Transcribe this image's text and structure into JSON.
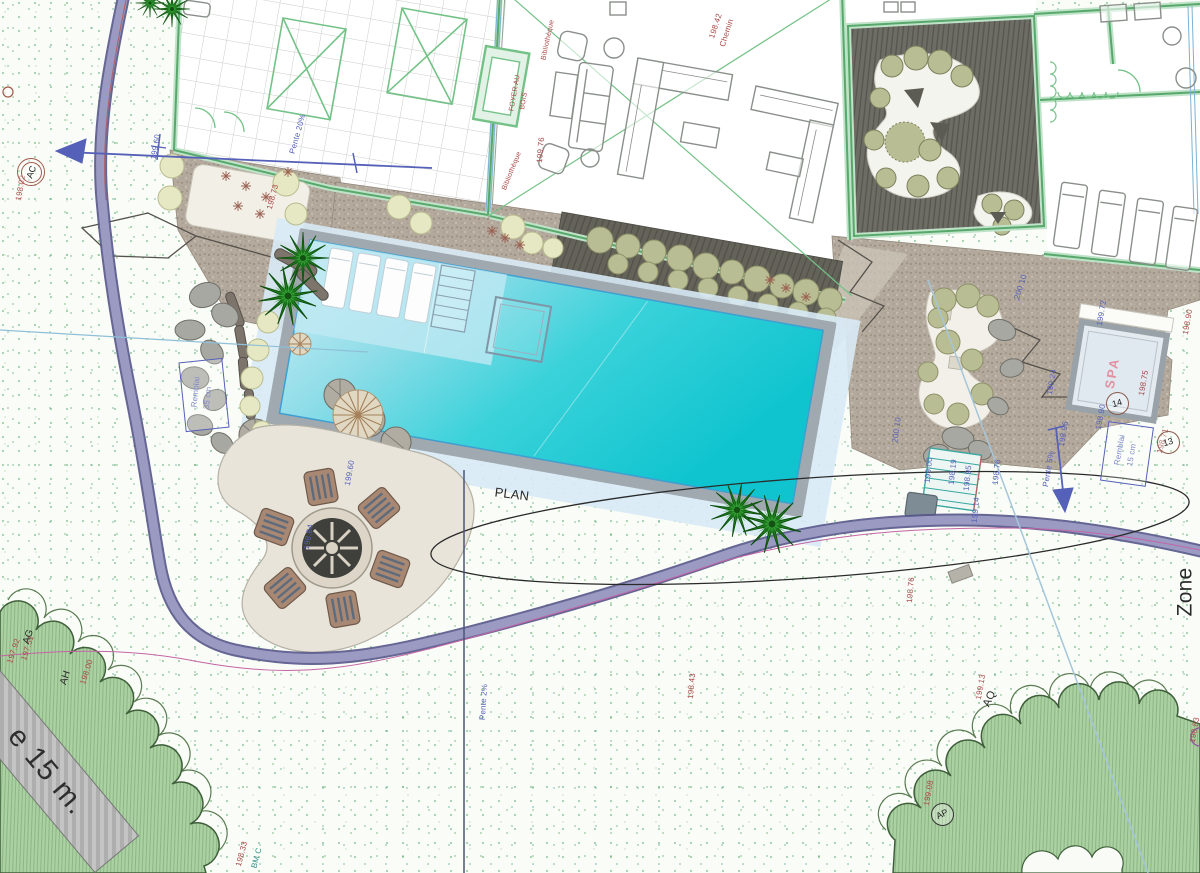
{
  "colors": {
    "pool_water": "#0fc4cf",
    "pool_water_light": "#cdeef7",
    "pool_coping": "#9fa9af",
    "wall_green": "#74c287",
    "path_purple": "#8e8ebb",
    "gravel": "#b4a99d",
    "deck_dark": "#6d6d66",
    "tree_mass_green": "#abd0a2",
    "annotation_red": "#a84848",
    "annotation_blue": "#5560b8",
    "spa_pink": "#e390a0",
    "palm_green": "#1e7d1e"
  },
  "scale_band": {
    "label": "e 15 m."
  },
  "annotations": {
    "texts": [
      {
        "t": "198.42",
        "x": 716,
        "y": 26,
        "r": -72,
        "c": "red"
      },
      {
        "t": "Chemin",
        "x": 727,
        "y": 33,
        "r": -72,
        "c": "red"
      },
      {
        "t": "199.76",
        "x": 541,
        "y": 150,
        "r": -85,
        "c": "red"
      },
      {
        "t": "FOYER AU",
        "x": 515,
        "y": 93,
        "r": -80,
        "c": "red",
        "s": 7
      },
      {
        "t": "BOIS",
        "x": 524,
        "y": 101,
        "r": -80,
        "c": "red",
        "s": 7
      },
      {
        "t": "Bibliothèque",
        "x": 548,
        "y": 40,
        "r": -78,
        "c": "red",
        "s": 7
      },
      {
        "t": "Bibliothèque",
        "x": 512,
        "y": 171,
        "r": -68,
        "c": "red",
        "s": 7
      },
      {
        "t": "198.73",
        "x": 273,
        "y": 197,
        "r": -75,
        "c": "red"
      },
      {
        "t": "198.02",
        "x": 21,
        "y": 188,
        "r": -80,
        "c": "red"
      },
      {
        "t": "198.75",
        "x": 1144,
        "y": 383,
        "r": -80,
        "c": "red"
      },
      {
        "t": "198.71",
        "x": 1163,
        "y": 441,
        "r": -75,
        "c": "red"
      },
      {
        "t": "198.90",
        "x": 1188,
        "y": 322,
        "r": -80,
        "c": "red"
      },
      {
        "t": "198.76",
        "x": 911,
        "y": 590,
        "r": -85,
        "c": "red"
      },
      {
        "t": "198.43",
        "x": 692,
        "y": 686,
        "r": -85,
        "c": "red"
      },
      {
        "t": "197.92",
        "x": 14,
        "y": 651,
        "r": -72,
        "c": "red"
      },
      {
        "t": "197.51",
        "x": 28,
        "y": 648,
        "r": -72,
        "c": "red"
      },
      {
        "t": "198.00",
        "x": 87,
        "y": 672,
        "r": -72,
        "c": "red"
      },
      {
        "t": "199.13",
        "x": 981,
        "y": 687,
        "r": -80,
        "c": "red"
      },
      {
        "t": "199.08",
        "x": 929,
        "y": 793,
        "r": -80,
        "c": "red"
      },
      {
        "t": "198.83",
        "x": 1195,
        "y": 730,
        "r": -80,
        "c": "red"
      },
      {
        "t": "198.33",
        "x": 242,
        "y": 854,
        "r": -75,
        "c": "red"
      },
      {
        "t": "Pente 20%",
        "x": 298,
        "y": 134,
        "r": -74,
        "c": "blue"
      },
      {
        "t": "199.60",
        "x": 156,
        "y": 147,
        "r": -80,
        "c": "blue"
      },
      {
        "t": "199.60",
        "x": 350,
        "y": 473,
        "r": -80,
        "c": "blue"
      },
      {
        "t": "198.84",
        "x": 309,
        "y": 537,
        "r": -80,
        "c": "blue"
      },
      {
        "t": "200.10",
        "x": 897,
        "y": 430,
        "r": -82,
        "c": "blue"
      },
      {
        "t": "200.10",
        "x": 1021,
        "y": 287,
        "r": -72,
        "c": "blue"
      },
      {
        "t": "199.00",
        "x": 929,
        "y": 470,
        "r": -84,
        "c": "blue"
      },
      {
        "t": "198.19",
        "x": 953,
        "y": 472,
        "r": -84,
        "c": "blue"
      },
      {
        "t": "198.95",
        "x": 968,
        "y": 478,
        "r": -84,
        "c": "blue"
      },
      {
        "t": "198.76",
        "x": 997,
        "y": 472,
        "r": -84,
        "c": "blue"
      },
      {
        "t": "199.14",
        "x": 976,
        "y": 510,
        "r": -84,
        "c": "blue"
      },
      {
        "t": "Pente 5%",
        "x": 1049,
        "y": 469,
        "r": -80,
        "c": "blue"
      },
      {
        "t": "198.96",
        "x": 1064,
        "y": 434,
        "r": -80,
        "c": "blue"
      },
      {
        "t": "198.90",
        "x": 1101,
        "y": 417,
        "r": -80,
        "c": "blue"
      },
      {
        "t": "199.72",
        "x": 1102,
        "y": 313,
        "r": -80,
        "c": "blue"
      },
      {
        "t": "199.24",
        "x": 1052,
        "y": 382,
        "r": -80,
        "c": "blue"
      },
      {
        "t": "Pente 2%",
        "x": 484,
        "y": 702,
        "r": -86,
        "c": "blue"
      },
      {
        "t": "Remblai",
        "x": 196,
        "y": 392,
        "r": -84,
        "c": "blue"
      },
      {
        "t": "35 cm",
        "x": 208,
        "y": 398,
        "r": -84,
        "c": "blue"
      },
      {
        "t": "Remblai",
        "x": 1120,
        "y": 450,
        "r": -80,
        "c": "blue"
      },
      {
        "t": "15 cm",
        "x": 1132,
        "y": 455,
        "r": -80,
        "c": "blue"
      },
      {
        "t": "AG",
        "x": 29,
        "y": 637,
        "r": -72,
        "c": "black",
        "s": 10
      },
      {
        "t": "AH",
        "x": 66,
        "y": 678,
        "r": -72,
        "c": "black",
        "s": 10
      },
      {
        "t": "AQ",
        "x": 990,
        "y": 699,
        "r": -65,
        "c": "black",
        "s": 11
      },
      {
        "t": "PLAN",
        "x": 512,
        "y": 494,
        "r": 7,
        "c": "black",
        "s": 13
      },
      {
        "t": "Zone",
        "x": 1185,
        "y": 592,
        "r": -90,
        "c": "black",
        "s": 21
      },
      {
        "t": "BM C",
        "x": 257,
        "y": 858,
        "r": -75,
        "c": "teal"
      },
      {
        "t": "SPA",
        "x": 1112,
        "y": 373,
        "r": -80,
        "c": "pink",
        "s": 13
      }
    ],
    "boxes": [
      {
        "x": 182,
        "y": 360,
        "w": 42,
        "h": 68,
        "r": -6
      },
      {
        "x": 1104,
        "y": 424,
        "w": 44,
        "h": 58,
        "r": 8
      }
    ],
    "markers": [
      {
        "t": "AC",
        "x": 30,
        "y": 171,
        "rot": -70,
        "type": "double"
      },
      {
        "t": "14",
        "x": 1116,
        "y": 402,
        "rot": -15,
        "type": "single"
      },
      {
        "t": "13",
        "x": 1167,
        "y": 441,
        "rot": -15,
        "type": "single"
      },
      {
        "t": "AP",
        "x": 941,
        "y": 813,
        "rot": -25,
        "type": "single-dark"
      }
    ]
  }
}
